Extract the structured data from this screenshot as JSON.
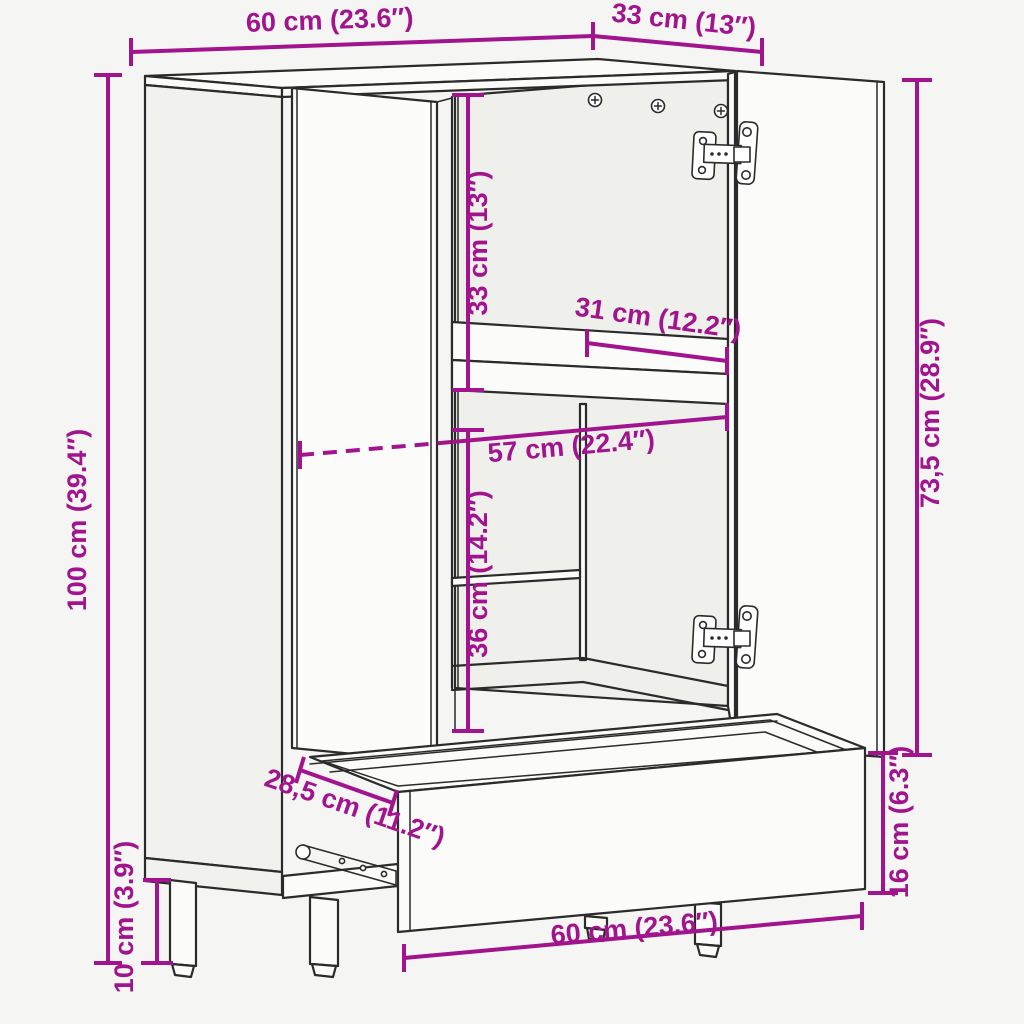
{
  "diagram": {
    "kind": "furniture-dimension-diagram",
    "colors": {
      "accent": "#A1148E",
      "line": "#2b2b2b",
      "background": "#f5f5f3"
    },
    "dims": {
      "top_width": {
        "label": "60 cm (23.6″)"
      },
      "top_depth": {
        "label": "33 cm (13″)"
      },
      "height": {
        "label": "100 cm (39.4″)"
      },
      "upper_compartment": {
        "label": "33 cm (13″)"
      },
      "shelf_depth": {
        "label": "31 cm (12.2″)"
      },
      "inner_width": {
        "label": "57 cm (22.4″)"
      },
      "lower_compartment": {
        "label": "36 cm (14.2″)"
      },
      "door_height": {
        "label": "73,5 cm (28.9″)"
      },
      "drawer_front_height": {
        "label": "16 cm (6.3″)"
      },
      "drawer_depth": {
        "label": "28,5 cm (11.2″)"
      },
      "leg_height": {
        "label": "10 cm (3.9″)"
      },
      "bottom_width": {
        "label": "60 cm (23.6″)"
      }
    }
  }
}
